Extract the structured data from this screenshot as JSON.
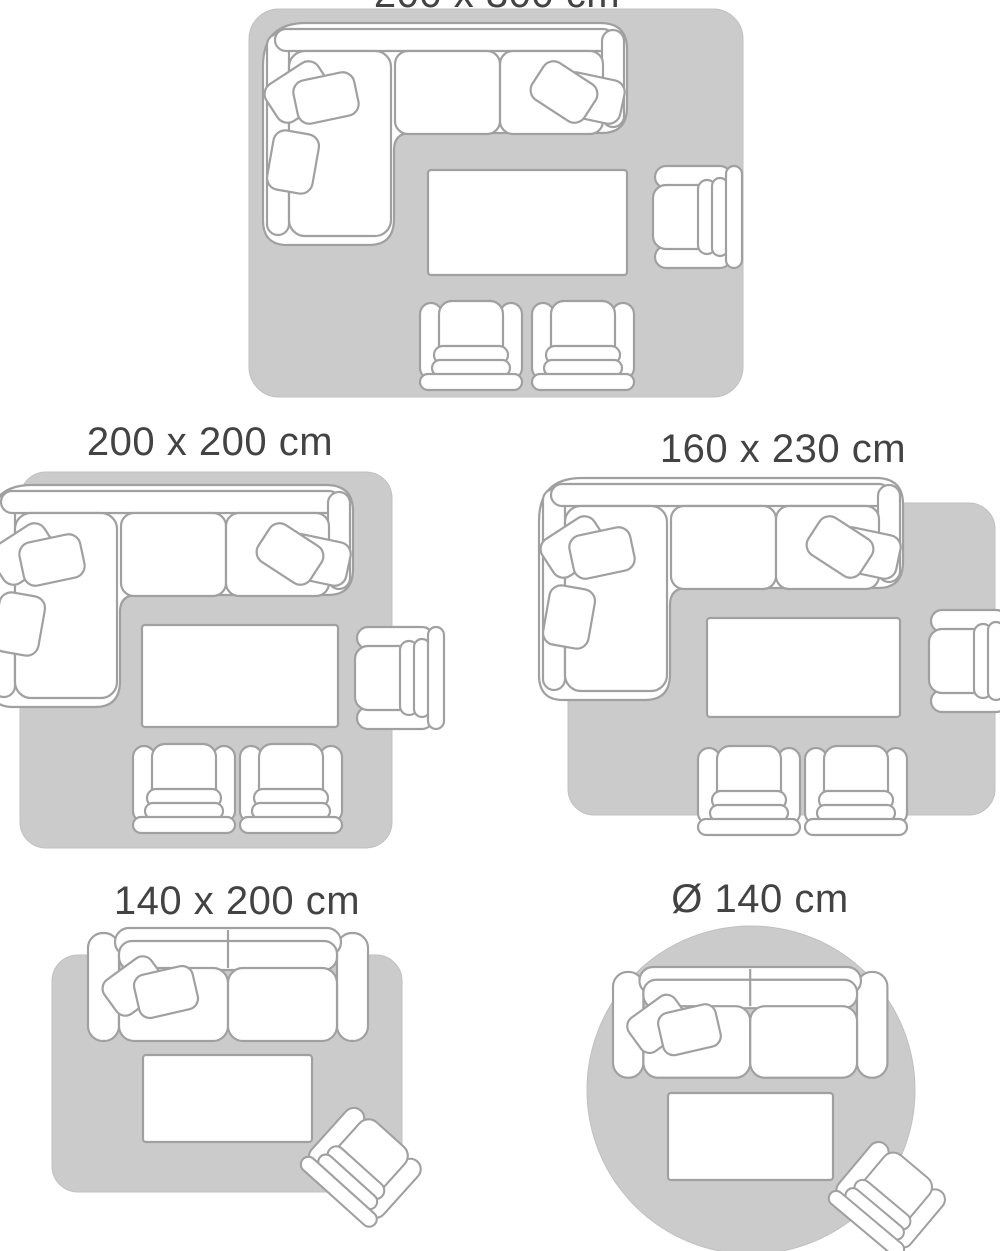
{
  "colors": {
    "background": "#ffffff",
    "rug_fill": "#cbcbcb",
    "furniture_outline": "#a0a0a0",
    "furniture_fill": "#ffffff",
    "label_text": "#434343"
  },
  "size_options": [
    {
      "label": "200 x 300 cm",
      "rug_shape": "rectangle",
      "label_visibility": "partially-cut-at-top",
      "furniture": [
        "corner-sofa",
        "coffee-table",
        "armchair-side",
        "armchair",
        "armchair"
      ]
    },
    {
      "label": "200 x 200 cm",
      "rug_shape": "square",
      "furniture": [
        "corner-sofa",
        "coffee-table",
        "armchair-side",
        "armchair",
        "armchair"
      ]
    },
    {
      "label": "160 x 230 cm",
      "rug_shape": "rectangle",
      "furniture": [
        "corner-sofa",
        "coffee-table",
        "armchair-side",
        "armchair",
        "armchair"
      ]
    },
    {
      "label": "140 x 200 cm",
      "rug_shape": "rectangle",
      "furniture": [
        "two-seat-sofa",
        "coffee-table",
        "armchair-angled"
      ]
    },
    {
      "label": "Ø 140 cm",
      "rug_shape": "circle",
      "furniture": [
        "two-seat-sofa",
        "coffee-table",
        "armchair-angled"
      ]
    }
  ]
}
